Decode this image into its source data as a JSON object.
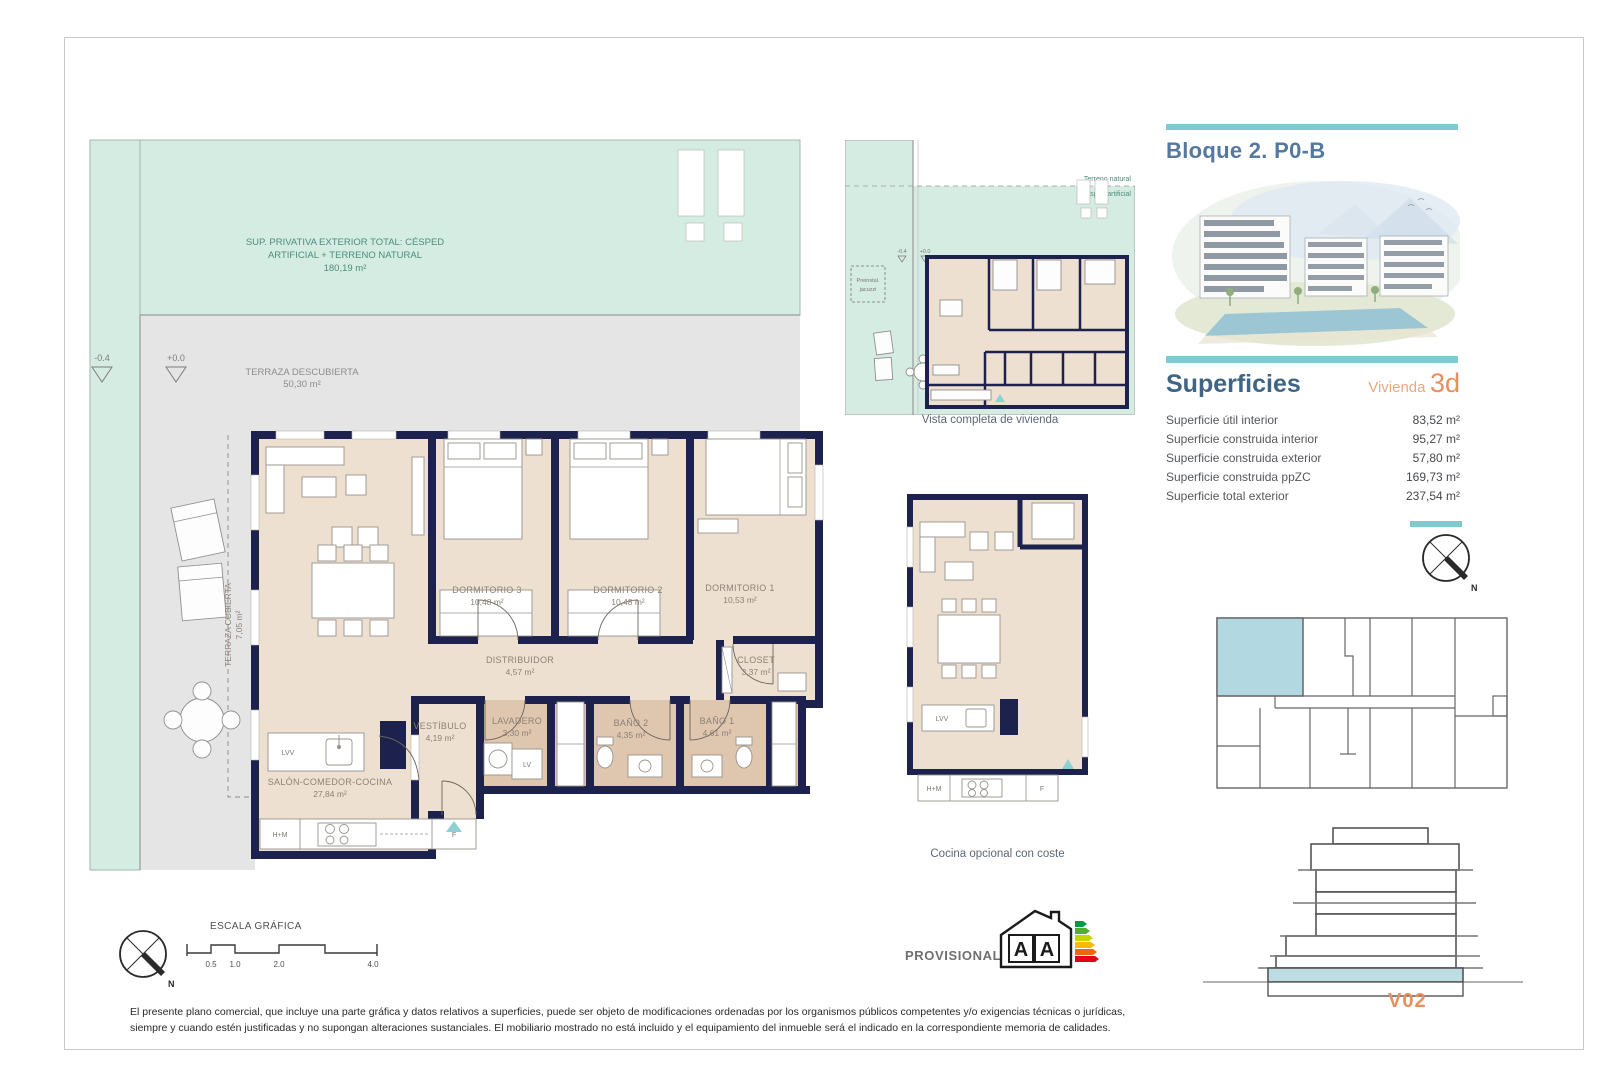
{
  "header": {
    "block_title": "Bloque 2. P0-B"
  },
  "superficies": {
    "heading": "Superficies",
    "unit_type_label": "Vivienda",
    "unit_type_value": "3d",
    "rows": [
      {
        "label": "Superficie útil interior",
        "value": "83,52 m²"
      },
      {
        "label": "Superficie construida interior",
        "value": "95,27 m²"
      },
      {
        "label": "Superficie construida exterior",
        "value": "57,80 m²"
      },
      {
        "label": "Superficie construida ppZC",
        "value": "169,73 m²"
      },
      {
        "label": "Superficie total exterior",
        "value": "237,54 m²"
      }
    ]
  },
  "main_plan": {
    "exterior_note": {
      "line1": "SUP. PRIVATIVA EXTERIOR TOTAL: CÉSPED",
      "line2": "ARTIFICIAL + TERRENO NATURAL",
      "area": "180,19 m²"
    },
    "level_markers": {
      "low": "-0.4",
      "zero": "+0.0"
    },
    "terraza_descubierta": {
      "name": "TERRAZA DESCUBIERTA",
      "area": "50,30 m²"
    },
    "terraza_cubierta": {
      "name": "TERRAZA CUBIERTA",
      "area": "7,05 m²"
    },
    "rooms": [
      {
        "name": "DORMITORIO 3",
        "area": "10,48 m²"
      },
      {
        "name": "DORMITORIO 2",
        "area": "10,48 m²"
      },
      {
        "name": "DORMITORIO 1",
        "area": "10,53 m²"
      },
      {
        "name": "DISTRIBUIDOR",
        "area": "4,57 m²"
      },
      {
        "name": "CLOSET",
        "area": "3,37 m²"
      },
      {
        "name": "VESTÍBULO",
        "area": "4,19 m²"
      },
      {
        "name": "LAVADERO",
        "area": "3,30 m²"
      },
      {
        "name": "BAÑO 2",
        "area": "4,35 m²"
      },
      {
        "name": "BAÑO 1",
        "area": "4,61 m²"
      },
      {
        "name": "SALÓN-COMEDOR-COCINA",
        "area": "27,84 m²"
      }
    ],
    "labels": {
      "lvv": "LVV",
      "lv": "LV",
      "hm": "H+M",
      "f": "F"
    }
  },
  "overview_plan": {
    "caption": "Vista completa de vivienda",
    "terrain_top": "Terreno natural",
    "terrain_bottom": "Césped artificial",
    "jacuzzi_line1": "Preinstal.",
    "jacuzzi_line2": "jacuzzi",
    "level_low": "-0.4",
    "level_zero": "+0.0"
  },
  "kitchen_plan": {
    "caption": "Cocina opcional con coste",
    "lvv": "LVV",
    "hm": "H+M",
    "f": "F"
  },
  "scale_bar": {
    "label": "ESCALA GRÁFICA",
    "ticks": [
      "0.5",
      "1.0",
      "2.0",
      "4.0"
    ]
  },
  "compass": {
    "north": "N"
  },
  "watermark": "El",
  "footer": {
    "provisional": "PROVISIONAL",
    "energy_letter_left": "A",
    "energy_letter_right": "A",
    "disclaimer": "El presente plano comercial, que incluye una parte gráfica y datos relativos a superficies, puede ser objeto de modificaciones ordenadas por los organismos públicos competentes y/o exigencias técnicas o jurídicas, siempre y cuando estén justificadas y no supongan alteraciones sustanciales. El mobiliario mostrado no está incluido y el equipamiento del inmueble será el indicado en la correspondiente memoria de calidades.",
    "version": "V02"
  },
  "colors": {
    "accent_teal": "#7fc9cf",
    "mint": "#d5ece2",
    "wall_navy": "#1c214d",
    "room_beige": "#eee0d0",
    "bath_tan": "#dfc6ae",
    "terrace_gray": "#e5e5e5",
    "title_blue": "#55789f",
    "heading_blue": "#3f6484",
    "salmon": "#e78f5e",
    "highlight_blue": "#b2d9e1"
  }
}
